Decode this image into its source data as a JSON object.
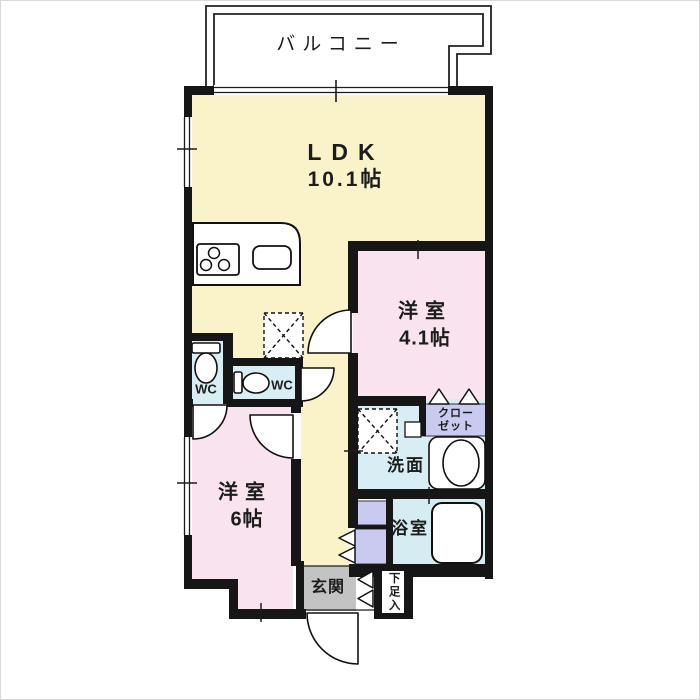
{
  "plan": {
    "balcony": {
      "label": "バルコニー"
    },
    "ldk": {
      "label": "LDK",
      "size": "10.1帖"
    },
    "bedroom_41": {
      "label": "洋室",
      "size": "4.1帖"
    },
    "bedroom_6": {
      "label": "洋室",
      "size": "6帖"
    },
    "closet": {
      "label": "クローゼット"
    },
    "wc_left": {
      "label": "WC"
    },
    "wc_right": {
      "label": "WC"
    },
    "washroom": {
      "label": "洗面"
    },
    "bathroom": {
      "label": "浴室"
    },
    "entrance": {
      "label": "玄関"
    },
    "shoe_cabinet": {
      "label": "下足入"
    }
  },
  "colors": {
    "wall": "#161616",
    "ldk_floor": "#faf3c9",
    "bedroom_floor": "#f8e3ee",
    "wet_area_floor": "#d9edf4",
    "closet_fill": "#c8cbef",
    "entrance_floor": "#c3c3c3",
    "line": "#1c1c1c"
  }
}
